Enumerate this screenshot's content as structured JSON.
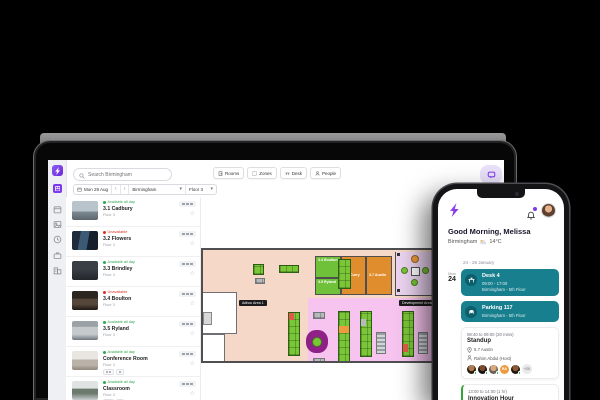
{
  "colors": {
    "accent": "#7C3AED",
    "teal": "#177F8E",
    "status_green": "#2FA84F",
    "status_red": "#D93025",
    "desk_green": "#79C636",
    "room_green": "#6FC13A",
    "room_orange": "#E08E2D",
    "zone_peach": "#F5D8C8",
    "zone_pink": "#F7C4EF",
    "zone_pod": "#EBD4F0"
  },
  "icons": {
    "star": "☆",
    "chevron_down": "▾",
    "arrow_prev": "‹",
    "arrow_next": "›"
  },
  "laptop": {
    "search_placeholder": "Search Birmingham",
    "filters": {
      "date": "Mon 29 Aug",
      "location": "Birmingham",
      "floor": "Floor 3"
    },
    "view_buttons": [
      {
        "label": "Rooms"
      },
      {
        "label": "Zones"
      },
      {
        "label": "Desk"
      },
      {
        "label": "People"
      }
    ],
    "rooms": [
      {
        "status": "Available all day",
        "name": "3.1 Cadbury",
        "floor": "Floor 3"
      },
      {
        "status": "Unavailable",
        "name": "3.2 Flowers",
        "floor": "Floor 3"
      },
      {
        "status": "Available all day",
        "name": "3.3 Brindley",
        "floor": "Floor 3"
      },
      {
        "status": "Unavailable",
        "name": "3.4 Boulton",
        "floor": "Floor 3"
      },
      {
        "status": "Available all day",
        "name": "3.5 Ryland",
        "floor": "Floor 3"
      },
      {
        "status": "Available all day",
        "name": "Conference Room",
        "floor": "Floor 3"
      },
      {
        "status": "Available all day",
        "name": "Classroom",
        "floor": "Floor 3"
      }
    ],
    "floorplan": {
      "zones": [
        {
          "label": "Adhoc Area 1"
        },
        {
          "label": "Development Area"
        }
      ],
      "rooms": [
        {
          "label": "3.4 Boulton"
        },
        {
          "label": "3.5 Ryland"
        },
        {
          "label": "3.6 Curry"
        },
        {
          "label": "3.7 Austin"
        }
      ]
    }
  },
  "phone": {
    "greeting": "Good Morning, Melissa",
    "city": "Birmingham",
    "temperature": "14°C",
    "date_range": "24 - 28 January",
    "day": {
      "dow": "Mon",
      "num": "24"
    },
    "bookings": [
      {
        "title": "Desk 4",
        "time": "09:00 - 17:00",
        "place": "Birmingham - 5th Floor"
      },
      {
        "title": "Parking 117",
        "place": "Birmingham - 5th Floor"
      }
    ],
    "events": [
      {
        "time": "08:40 to 09:00 (20 mins)",
        "title": "Standup",
        "room": "5.7 Austin",
        "host": "Rahim Abdul (Host)",
        "badge": "RA",
        "more": "+20"
      },
      {
        "time": "13:00 to 14:00 (1 hr)",
        "title": "Innovation Hour"
      }
    ]
  }
}
